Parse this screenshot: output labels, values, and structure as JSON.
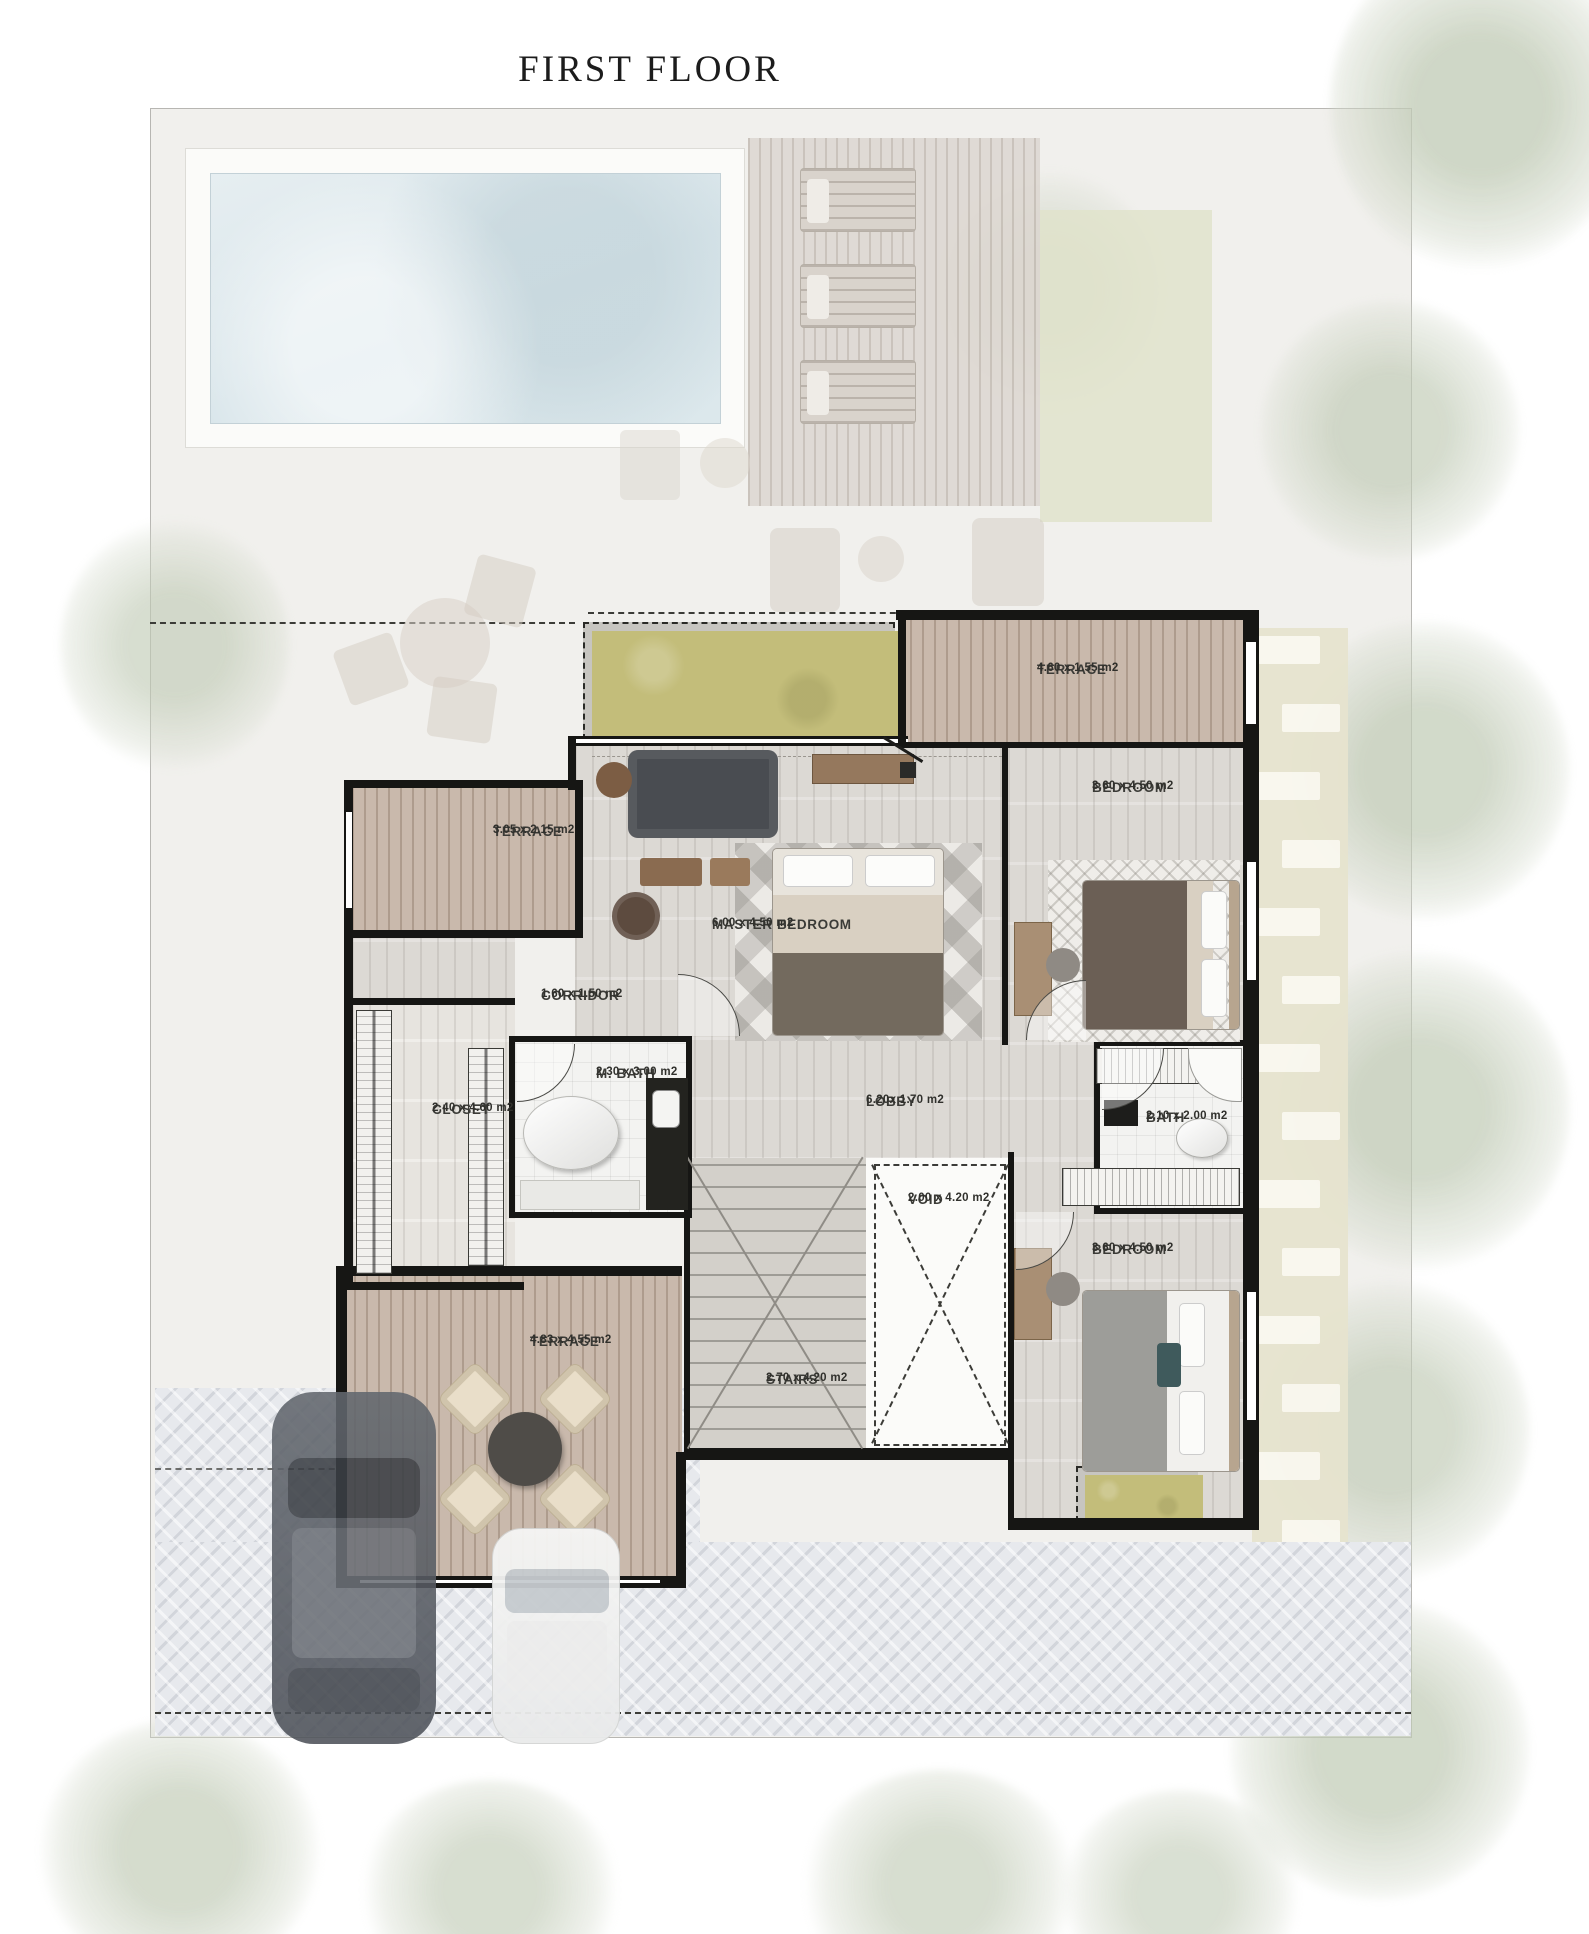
{
  "title": "FIRST FLOOR",
  "rooms": {
    "terrace_top_right": {
      "name": "TERRACE",
      "dims": "4.60 x 1.55 m2"
    },
    "bedroom_top_right": {
      "name": "BEDROOM",
      "dims": "3.60 x 4.50 m2"
    },
    "terrace_left": {
      "name": "TERRACE",
      "dims": "3.05 x 2.15 m2"
    },
    "master_bedroom": {
      "name": "MASTER BEDROOM",
      "dims": "6.00 x 4.50 m2"
    },
    "corridor": {
      "name": "CORRIDOR",
      "dims": "1.60 x 1.50 m2"
    },
    "closet": {
      "name": "CLOSET",
      "dims": "2.40 x 4.60 m2"
    },
    "m_bath": {
      "name": "M. BATH",
      "dims": "2.30 x 3.00 m2"
    },
    "lobby": {
      "name": "LOBBY",
      "dims": "6.20x 1.70 m2"
    },
    "bath": {
      "name": "BATH",
      "dims": "2.10 x 2.00 m2"
    },
    "void": {
      "name": "VOID",
      "dims": "2.00 x 4.20 m2"
    },
    "bedroom_bottom_right": {
      "name": "BEDROOM",
      "dims": "3.60 x 4.50 m2"
    },
    "terrace_bottom": {
      "name": "TERRACE",
      "dims": "4.83 x 4.55 m2"
    },
    "stairs": {
      "name": "STAIRS",
      "dims": "2.70 x 4.20 m2"
    }
  },
  "colors": {
    "wall": "#161614",
    "water": "#dfe9ee",
    "deck": "#c9b9ac",
    "floor": "#dcd9d4",
    "planter": "#c3bd7a",
    "paving": "#e7e9ed",
    "stone": "#faf8ef",
    "tree": "#dde3d5"
  }
}
